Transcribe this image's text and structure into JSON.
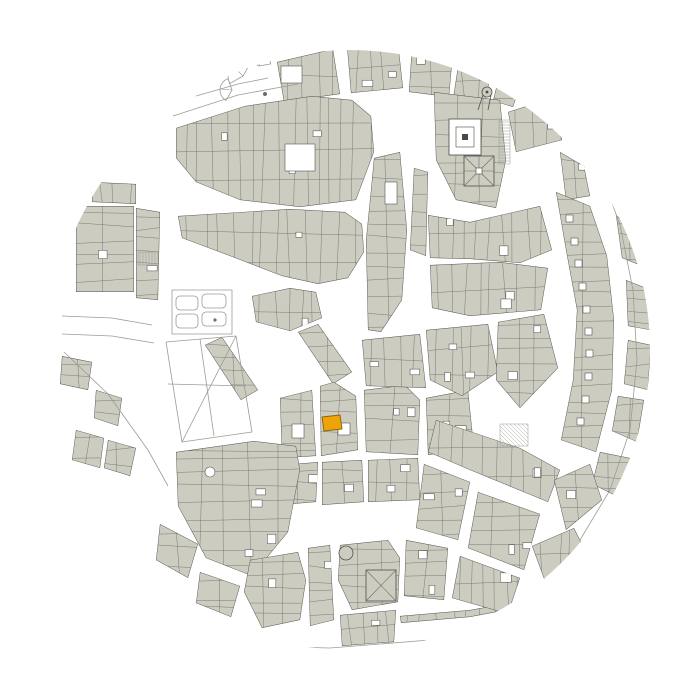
{
  "map": {
    "width": 700,
    "height": 700,
    "circle": {
      "cx": 350,
      "cy": 350,
      "r": 300
    },
    "seed": 7,
    "parcel_spacing": 13,
    "colors": {
      "background": "#ffffff",
      "building": "#cdccc1",
      "outline": "#51514b",
      "parcel": "#6d6d66",
      "court_stroke": "#55554f",
      "light": "#9b9b96",
      "dark": "#4a4a44",
      "highlight": "#efa30b",
      "highlight_stroke": "#8a6200"
    },
    "highlight": {
      "points": "322,417 340,415 342,429 324,431"
    },
    "blocks": [
      {
        "p": "277,62 333,49 340,94 284,102",
        "c": 0
      },
      {
        "p": "347,46 398,42 403,88 351,93",
        "c": 2
      },
      {
        "p": "412,46 453,52 449,97 409,92",
        "c": 1
      },
      {
        "p": "459,60 493,68 485,100 453,99",
        "c": 1
      },
      {
        "p": "499,76 521,84 513,107 493,101",
        "c": 0
      },
      {
        "p": "176,128 245,106 312,96 352,100 371,116 374,152 356,200 300,207 240,200 196,182 176,158",
        "c": 3
      },
      {
        "p": "178,216 290,209 345,212 362,224 364,252 348,278 318,284 282,276 230,256 182,238",
        "c": 2
      },
      {
        "p": "374,158 400,152 407,230 402,300 381,332 368,330 366,240 371,190",
        "c": 0
      },
      {
        "p": "414,168 428,172 426,256 410,250",
        "c": 0
      },
      {
        "p": "434,92 500,100 506,160 496,208 456,200 436,160",
        "c": 0
      },
      {
        "p": "508,112 552,98 562,140 516,152",
        "c": 1
      },
      {
        "p": "560,152 584,166 590,196 566,200",
        "c": 1
      },
      {
        "p": "428,215 470,222 540,206 552,250 520,263 470,259 430,258",
        "c": 2
      },
      {
        "p": "430,265 500,262 548,268 541,310 470,316 432,308",
        "c": 2
      },
      {
        "p": "556,192 590,206 607,256 614,320 612,390 596,452 561,440 573,380 577,310 566,250",
        "c": 0
      },
      {
        "p": "616,215 641,236 647,268 622,258",
        "c": 0
      },
      {
        "p": "626,280 651,290 650,330 628,326",
        "c": 0
      },
      {
        "p": "628,340 651,345 648,390 624,384",
        "c": 0
      },
      {
        "p": "618,396 644,400 637,442 612,431",
        "c": 0
      },
      {
        "p": "600,452 630,458 618,497 592,484",
        "c": 0
      },
      {
        "p": "76,206 134,206 134,292 76,292",
        "c": 1
      },
      {
        "p": "136,208 160,212 158,300 136,298",
        "c": 1
      },
      {
        "p": "92,182 136,184 136,204 92,202",
        "c": 0
      },
      {
        "p": "205,345 222,337 258,390 241,400",
        "c": 0
      },
      {
        "p": "298,332 318,324 352,372 333,384",
        "c": 0
      },
      {
        "p": "252,296 290,288 316,292 322,318 290,331 256,322",
        "c": 1
      },
      {
        "p": "280,398 312,390 316,456 282,458",
        "c": 0
      },
      {
        "p": "320,386 334,382 356,396 358,450 321,456",
        "c": 0
      },
      {
        "p": "364,390 405,385 420,400 418,455 366,452",
        "c": 2
      },
      {
        "p": "426,398 468,390 474,448 428,455",
        "c": 2
      },
      {
        "p": "282,465 318,462 316,502 280,505",
        "c": 1
      },
      {
        "p": "322,462 362,460 364,502 322,505",
        "c": 1
      },
      {
        "p": "368,460 418,458 420,500 368,502",
        "c": 2
      },
      {
        "p": "362,340 420,334 426,388 366,386",
        "c": 2
      },
      {
        "p": "176,452 254,441 296,446 300,470 288,532 252,576 206,558 178,506",
        "c": 4
      },
      {
        "p": "160,524 198,544 188,578 156,560",
        "c": 0
      },
      {
        "p": "200,572 240,586 231,617 196,603",
        "c": 0
      },
      {
        "p": "96,390 122,398 118,426 94,418",
        "c": 0
      },
      {
        "p": "76,430 104,438 100,468 72,460",
        "c": 0
      },
      {
        "p": "108,440 136,448 130,476 104,468",
        "c": 0
      },
      {
        "p": "62,356 92,362 88,390 60,384",
        "c": 0
      },
      {
        "p": "250,560 298,552 306,580 300,620 262,628 244,592",
        "c": 1
      },
      {
        "p": "308,548 330,545 334,620 310,626",
        "c": 1
      },
      {
        "p": "340,545 388,540 400,558 398,602 352,610 338,580",
        "c": 0
      },
      {
        "p": "406,540 448,548 444,600 404,596",
        "c": 2
      },
      {
        "p": "340,615 396,610 394,642 342,646",
        "c": 1
      },
      {
        "p": "400,616 470,610 558,594 560,600 470,617 401,623",
        "c": 0
      },
      {
        "p": "426,330 488,324 498,372 462,396 430,380",
        "c": 3
      },
      {
        "p": "498,322 544,314 558,368 520,408 496,380",
        "c": 2
      },
      {
        "p": "436,420 520,448 560,470 548,502 470,470 428,452",
        "c": 3
      },
      {
        "p": "424,464 470,482 458,540 416,528",
        "c": 2
      },
      {
        "p": "478,492 540,514 524,570 468,548",
        "c": 2
      },
      {
        "p": "554,480 590,464 602,500 566,530",
        "c": 1
      },
      {
        "p": "460,556 520,578 508,614 452,598",
        "c": 1
      },
      {
        "p": "532,546 574,528 590,560 546,584",
        "c": 1
      }
    ],
    "specials": [
      {
        "t": "wrect",
        "x": 281,
        "y": 66,
        "w": 21,
        "h": 17
      },
      {
        "t": "wrect",
        "x": 285,
        "y": 144,
        "w": 30,
        "h": 27
      },
      {
        "t": "wrect",
        "x": 385,
        "y": 182,
        "w": 12,
        "h": 22
      },
      {
        "t": "wrect",
        "x": 292,
        "y": 424,
        "w": 12,
        "h": 14
      },
      {
        "t": "wrect",
        "x": 338,
        "y": 423,
        "w": 12,
        "h": 12
      },
      {
        "t": "wdot",
        "cx": 210,
        "cy": 472,
        "r": 5
      },
      {
        "t": "cloister",
        "x": 449,
        "y": 119,
        "w": 32,
        "h": 36
      },
      {
        "t": "star",
        "x": 464,
        "y": 156,
        "w": 30,
        "h": 30
      },
      {
        "t": "turret",
        "cx": 487,
        "cy": 92,
        "r": 5
      },
      {
        "t": "apse",
        "cx": 346,
        "cy": 553,
        "r": 7
      },
      {
        "t": "xroof",
        "x": 366,
        "y": 570,
        "w": 30,
        "h": 31
      },
      {
        "t": "stripes",
        "x": 138,
        "y": 252,
        "w": 20,
        "h": 13,
        "dir": "v"
      },
      {
        "t": "stripes",
        "x": 499,
        "y": 120,
        "w": 11,
        "h": 44,
        "dir": "h"
      },
      {
        "t": "stripes",
        "x": 500,
        "y": 424,
        "w": 28,
        "h": 22,
        "dir": "d"
      },
      {
        "t": "fan",
        "cx": 243,
        "cy": 76,
        "r": 15,
        "a1": 150,
        "a2": 300
      },
      {
        "t": "fan",
        "cx": 259,
        "cy": 66,
        "r": 12,
        "a1": 210,
        "a2": 350
      },
      {
        "t": "fan",
        "cx": 232,
        "cy": 90,
        "r": 12,
        "a1": 120,
        "a2": 250
      },
      {
        "t": "dot",
        "cx": 265,
        "cy": 94,
        "r": 2
      },
      {
        "t": "bed",
        "x": 176,
        "y": 296,
        "w": 22,
        "h": 14
      },
      {
        "t": "bed",
        "x": 202,
        "y": 294,
        "w": 24,
        "h": 14
      },
      {
        "t": "bed",
        "x": 176,
        "y": 314,
        "w": 22,
        "h": 14
      },
      {
        "t": "bed",
        "x": 202,
        "y": 312,
        "w": 24,
        "h": 14
      },
      {
        "t": "dot",
        "cx": 215,
        "cy": 320,
        "r": 1.6
      },
      {
        "t": "sqrow",
        "size": 7,
        "squares": [
          [
            566,
            215
          ],
          [
            571,
            238
          ],
          [
            575,
            260
          ],
          [
            579,
            283
          ],
          [
            583,
            306
          ],
          [
            585,
            328
          ],
          [
            586,
            350
          ],
          [
            585,
            373
          ],
          [
            582,
            396
          ],
          [
            577,
            418
          ]
        ]
      }
    ],
    "lightlines": [
      {
        "p": "166,342 236,336 252,432 182,442 166,342"
      },
      {
        "p": "200,339 214,436"
      },
      {
        "p": "168,384 246,386"
      },
      {
        "p": "236,336 182,442"
      },
      {
        "p": "172,290 232,290 232,334 172,334 172,290"
      },
      {
        "p": "64,352 108,394 148,450 168,486"
      },
      {
        "p": "62,316 112,318 152,325"
      },
      {
        "p": "62,334 112,336 154,343"
      },
      {
        "p": "173,116 238,95 298,84"
      },
      {
        "p": "196,96 238,84 268,78"
      },
      {
        "p": "600,170 620,225 633,290 637,360 630,430 610,490 580,540"
      },
      {
        "p": "242,646 330,648 430,640 520,626 596,606"
      },
      {
        "p": "248,654 336,656 434,648"
      }
    ]
  }
}
